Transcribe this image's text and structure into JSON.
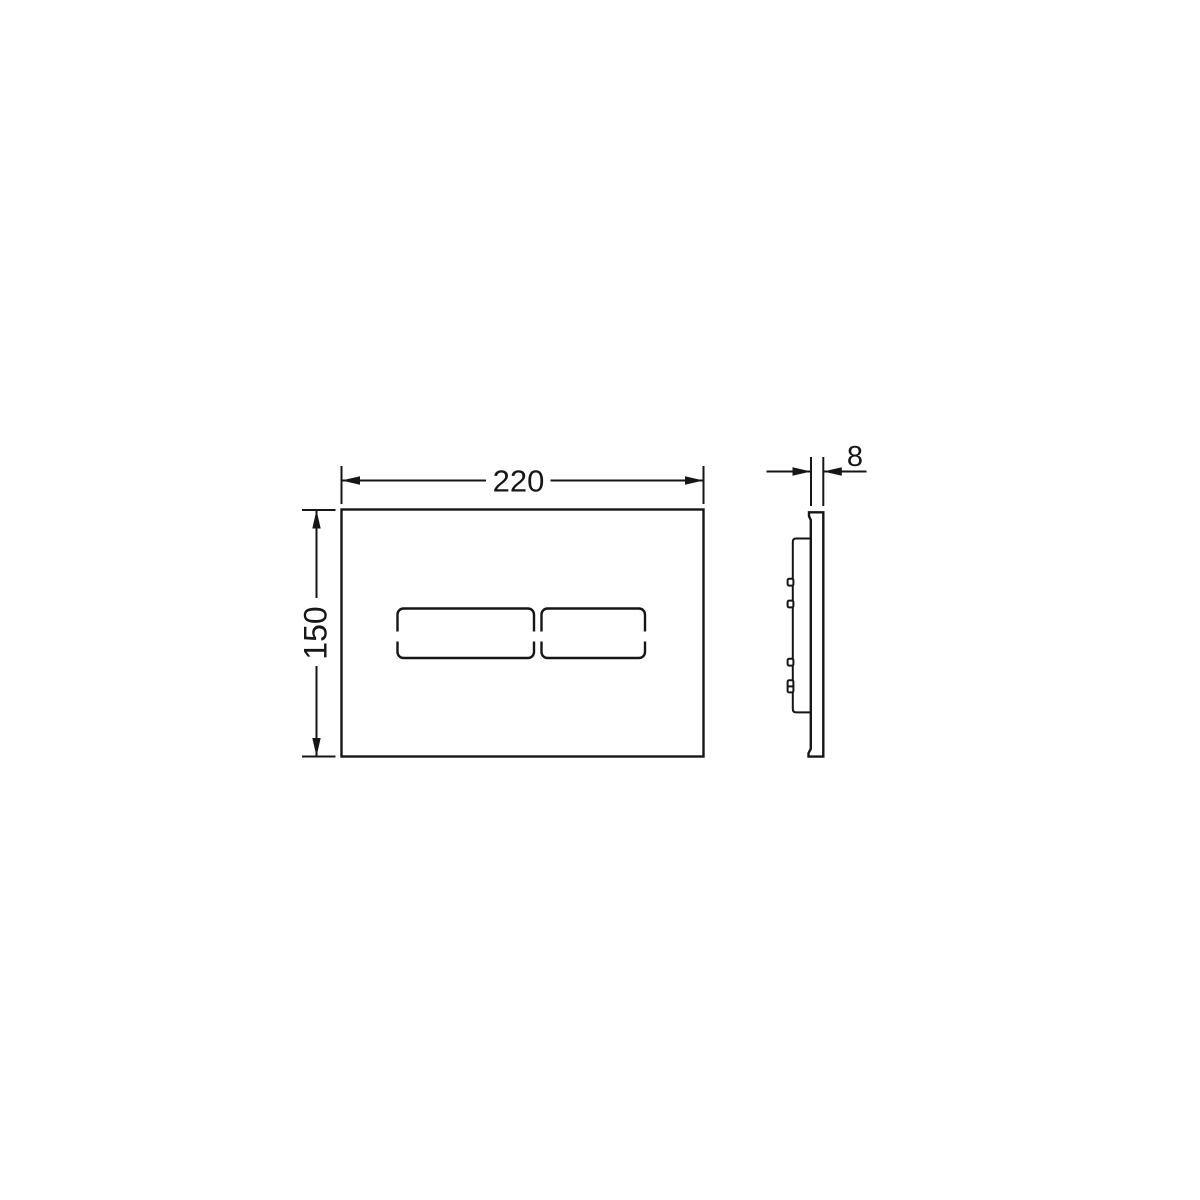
{
  "colors": {
    "background": "#ffffff",
    "line": "#161616"
  },
  "drawing": {
    "kind": "technical-dimension-drawing",
    "subject": "two-button-flush-plate",
    "views": {
      "front": {
        "button_count": 2
      },
      "side": {
        "clip_count": 4
      }
    },
    "dimensions": {
      "width": {
        "value": "220"
      },
      "height": {
        "value": "150"
      },
      "depth": {
        "value": "8"
      }
    }
  }
}
